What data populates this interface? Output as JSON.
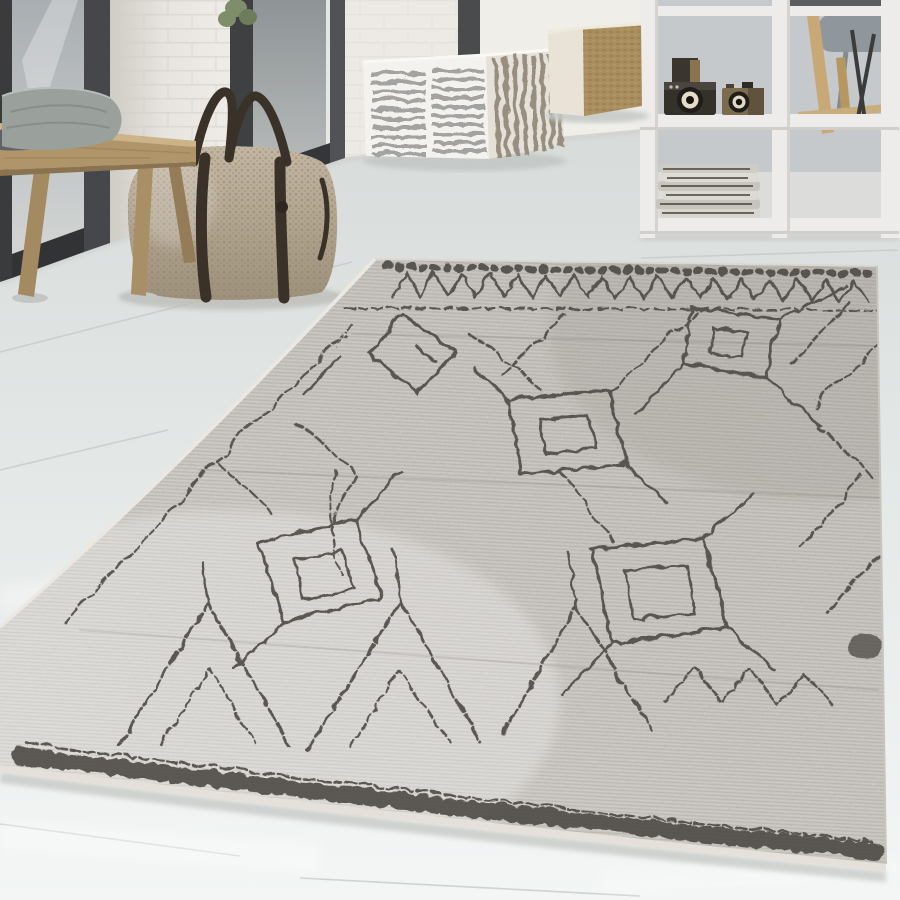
{
  "meta": {
    "title": "Cream Berber-style rug with charcoal tribal pattern in a bright interior",
    "media": "product-photograph",
    "canvas": {
      "width": 900,
      "height": 900
    },
    "visible_text": "none"
  },
  "scene": {
    "setting": "Bright Scandinavian-style room with whitewashed plank floor, dark-framed glass doors, white painted brick wall and a white cube shelving divider",
    "objects": [
      {
        "id": "berber-rug",
        "label": "Berber-style area rug",
        "details": "Cream/ivory low pile with irregular hand-drawn charcoal diamond-lattice motifs, open square medallions, zigzag rows and stitched dash hems along top and bottom edges"
      },
      {
        "id": "weekender-bag",
        "label": "Woven weekender bag",
        "details": "Beige dotted-weave duffel with dark brown leather handles and vertical front straps, standing on the floor"
      },
      {
        "id": "wooden-bench",
        "label": "Light wood bench",
        "details": "Chunky oak slab bench with splayed round legs, at left in front of the glass doors"
      },
      {
        "id": "bench-cushions",
        "label": "Grey cushions on the bench"
      },
      {
        "id": "striped-pouf",
        "label": "Striped cube pouf",
        "details": "Cream cube pouf with grey dashed stripes, vertical stripes on the side face"
      },
      {
        "id": "knitted-pouf",
        "label": "Knitted cube pouf",
        "details": "Camel/olive knitted cube pouf with cream side panel"
      },
      {
        "id": "cube-shelf",
        "label": "White cube shelving room divider"
      },
      {
        "id": "vintage-cameras",
        "label": "Two vintage cameras displayed on a shelf"
      },
      {
        "id": "magazine-stack",
        "label": "Stack of folded newspapers on lower shelf"
      },
      {
        "id": "glass-doors",
        "label": "Floor-to-ceiling glass doors with dark frames"
      },
      {
        "id": "brick-wall",
        "label": "White painted brick wall column"
      },
      {
        "id": "plant",
        "label": "Green plant seen at top of the glass"
      },
      {
        "id": "armchair",
        "label": "Grey chair seen behind the divider"
      },
      {
        "id": "easel",
        "label": "Wooden easel and dark tripod behind the divider"
      }
    ]
  },
  "colors": {
    "wall": "#e9e6e1",
    "frame_dark": "#3a3b3d",
    "glass": "#a9aeb2",
    "floor_top": "#d7dcdb",
    "floor_bottom": "#f3f6f5",
    "rug_light": "#e8e4dd",
    "rug_dark": "#c9c3bb",
    "rug_pattern": "#4e4a45",
    "rug_binding": "#e5e1da",
    "bench_wood": "#b0956a",
    "cushion_light": "#9aa09c",
    "cushion_dark": "#5f6266",
    "bag_light": "#c3b6a2",
    "bag_dark": "#9e917c",
    "bag_strap": "#3a3129",
    "pouf_base": "#f4f2ee",
    "pouf_stripe": "#a3a3a1",
    "pouf_side": "#e6e1d8",
    "cube_cream": "#e9e3d7",
    "cube_knit": "#a98e60",
    "shelf_white": "#edecea",
    "backdrop": "#c6c9cb",
    "chair_grey": "#8f969c",
    "easel_wood": "#c9a877",
    "camera_dark": "#34302a",
    "camera_olive": "#7c6c4e",
    "camera_ring": "#e3dcc8",
    "magazine_paper": "#d9d6d0",
    "plant_green": "#7f8d6b"
  },
  "rug": {
    "style": "Moroccan Berber",
    "ground": "cream / ivory",
    "pattern_color": "charcoal grey",
    "motifs": [
      "irregular diamond lattice",
      "open square medallions with inner squares",
      "large zigzag triangles near lower border",
      "zigzag band under top hem",
      "railroad stitch dashes along bottom border",
      "short stitch ticks along top hem"
    ]
  }
}
